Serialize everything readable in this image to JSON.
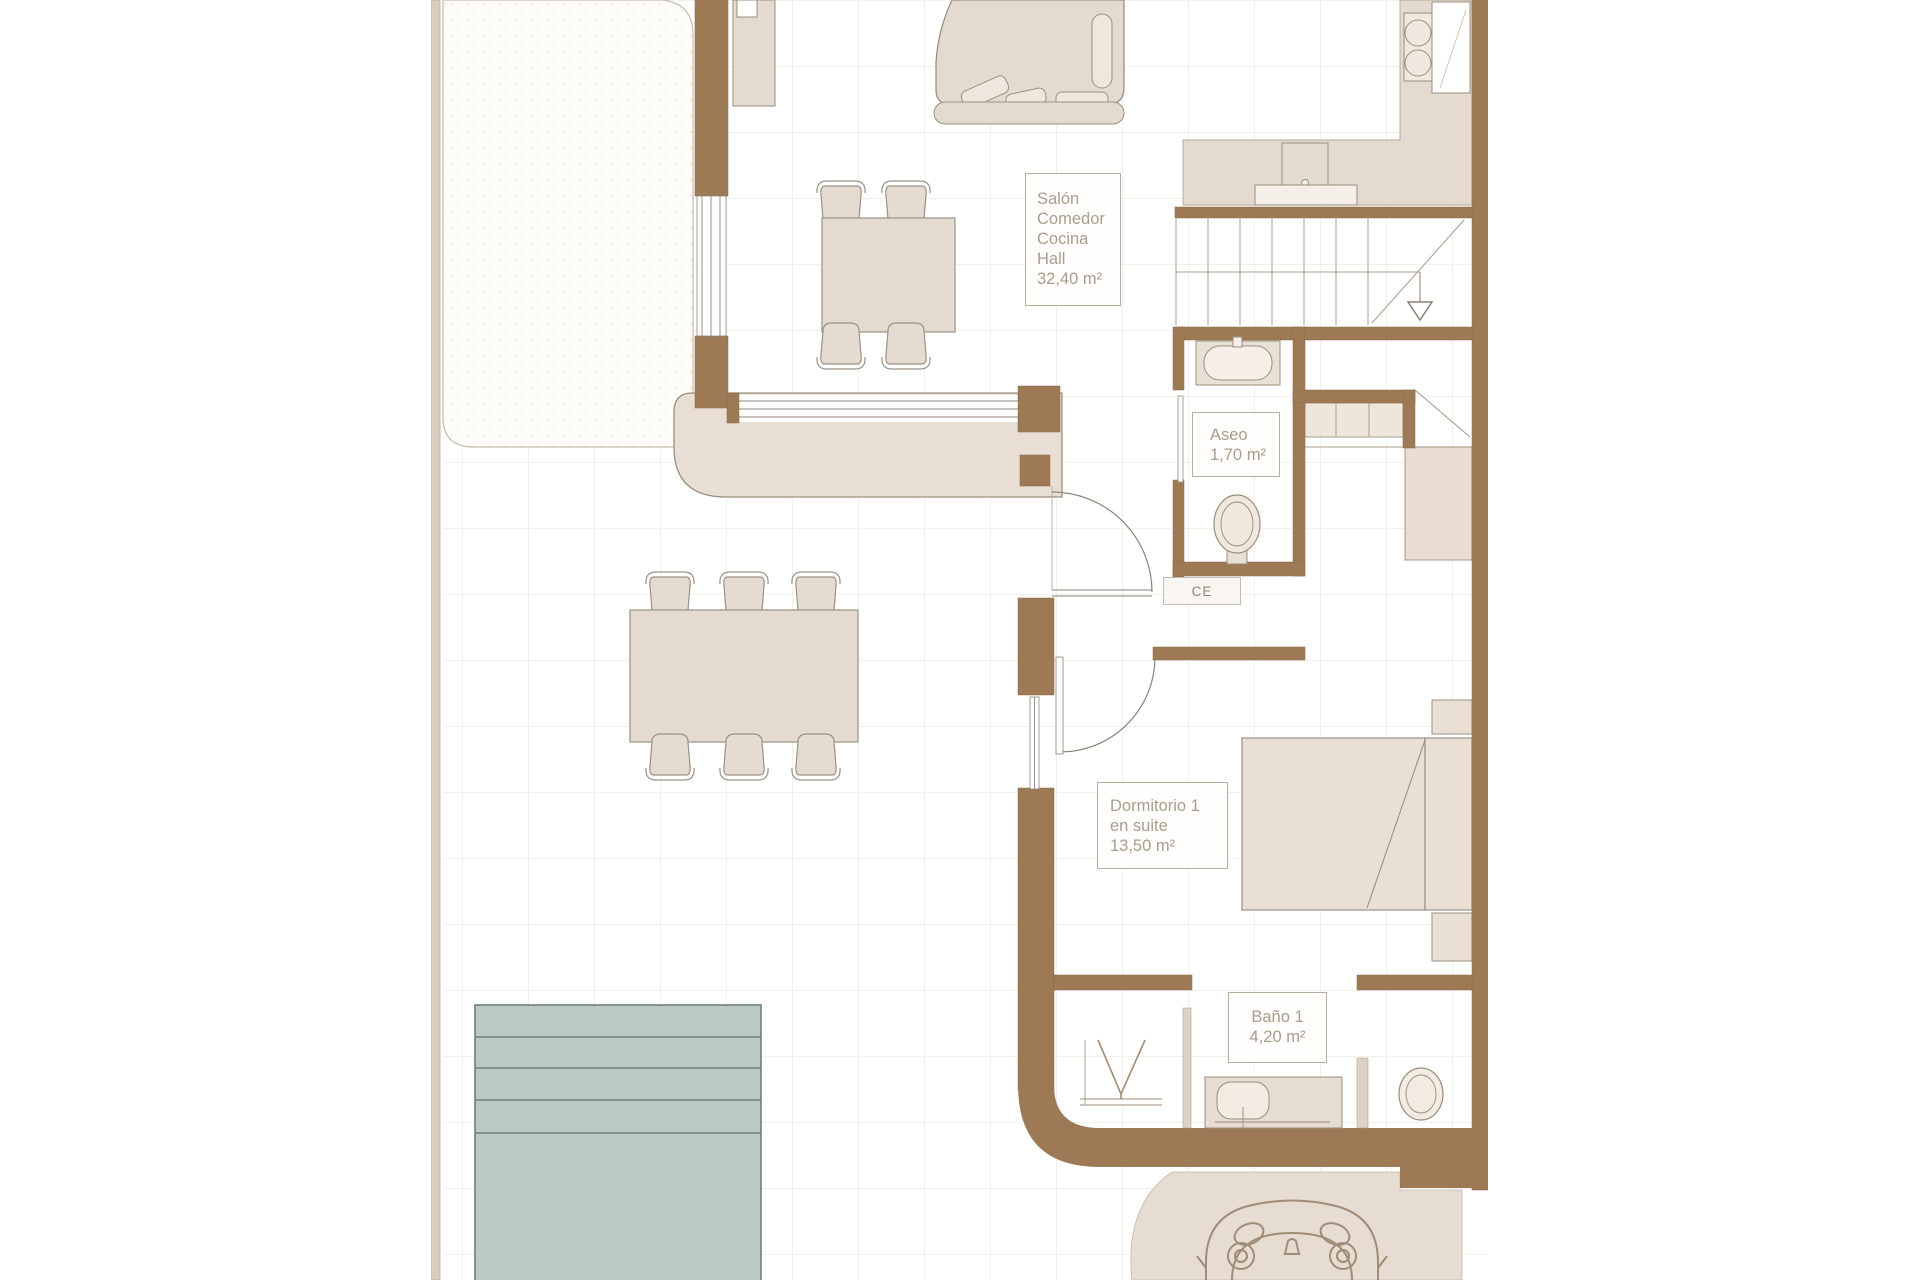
{
  "plan_type": "floor-plan",
  "rooms": {
    "salon": {
      "lines": [
        "Salón",
        "Comedor",
        "Cocina",
        "Hall"
      ],
      "area": "32,40 m²"
    },
    "aseo": {
      "lines": [
        "Aseo"
      ],
      "area": "1,70 m²"
    },
    "dormitorio1": {
      "lines": [
        "Dormitorio 1",
        "en suite"
      ],
      "area": "13,50 m²"
    },
    "bano1": {
      "lines": [
        "Baño 1"
      ],
      "area": "4,20 m²"
    }
  },
  "annotations": {
    "electrical_panel": "CE"
  },
  "colors": {
    "wall": "#9d7a55",
    "furniture_fill": "#e5dbd1",
    "furniture_stroke": "#96897b",
    "pool_fill": "#bccac7",
    "pool_line": "#6f7f7c",
    "grid_line": "#e7e2da",
    "label_text": "#a79d8d",
    "label_border": "#b8aea0"
  }
}
